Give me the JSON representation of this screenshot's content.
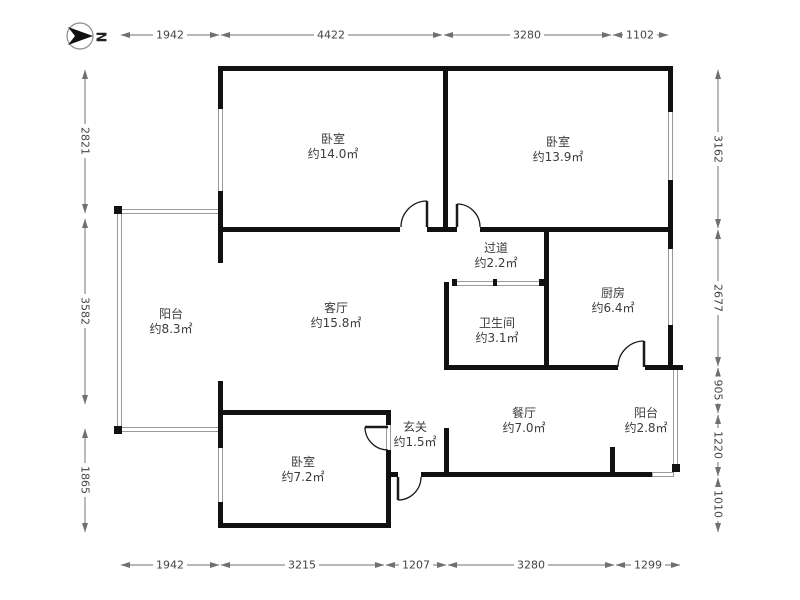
{
  "north": {
    "label": "N"
  },
  "rooms": [
    {
      "id": "bedroom-top-left",
      "name": "卧室",
      "area": "约14.0㎡"
    },
    {
      "id": "bedroom-top-right",
      "name": "卧室",
      "area": "约13.9㎡"
    },
    {
      "id": "hallway",
      "name": "过道",
      "area": "约2.2㎡"
    },
    {
      "id": "kitchen",
      "name": "厨房",
      "area": "约6.4㎡"
    },
    {
      "id": "balcony-left",
      "name": "阳台",
      "area": "约8.3㎡"
    },
    {
      "id": "living-room",
      "name": "客厅",
      "area": "约15.8㎡"
    },
    {
      "id": "bathroom",
      "name": "卫生间",
      "area": "约3.1㎡"
    },
    {
      "id": "dining-room",
      "name": "餐厅",
      "area": "约7.0㎡"
    },
    {
      "id": "balcony-right",
      "name": "阳台",
      "area": "约2.8㎡"
    },
    {
      "id": "bedroom-bottom",
      "name": "卧室",
      "area": "约7.2㎡"
    },
    {
      "id": "entry",
      "name": "玄关",
      "area": "约1.5㎡"
    }
  ],
  "dimensions": {
    "top": [
      "1942",
      "4422",
      "3280",
      "1102"
    ],
    "bottom": [
      "1942",
      "3215",
      "1207",
      "3280",
      "1299"
    ],
    "left": [
      "2821",
      "3582",
      "1865"
    ],
    "right": [
      "3162",
      "2677",
      "905",
      "1220",
      "1010"
    ]
  },
  "colors": {
    "wall": "#111111",
    "window_line": "#9a9a9a",
    "dimension_line": "#707070",
    "text": "#3c3c3c",
    "background": "#ffffff"
  }
}
